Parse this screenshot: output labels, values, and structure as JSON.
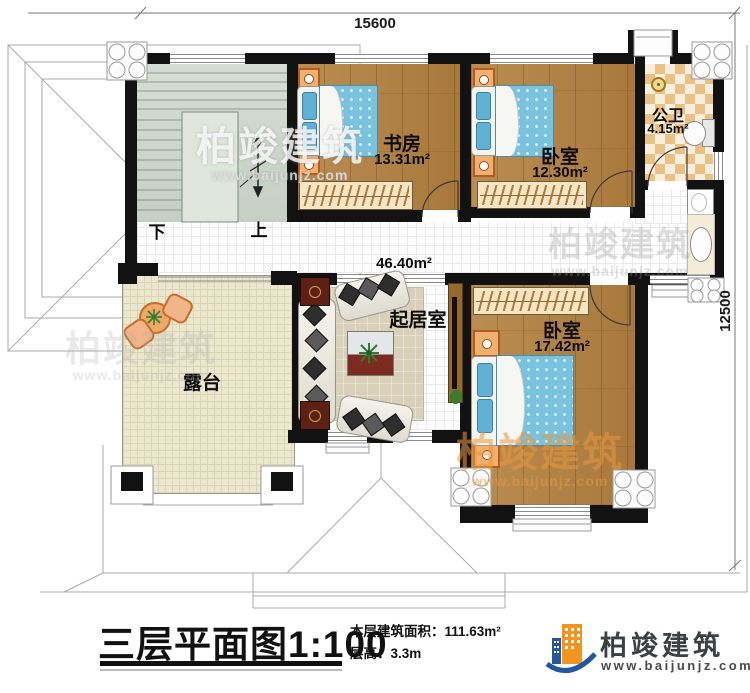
{
  "dimensions": {
    "width_mm": "15600",
    "height_mm": "12500"
  },
  "rooms": {
    "study": {
      "name": "书房",
      "area": "13.31m²"
    },
    "bedroom1": {
      "name": "卧室",
      "area": "12.30m²"
    },
    "bathroom": {
      "name": "公卫",
      "area": "4.15m²"
    },
    "living": {
      "name": "起居室",
      "area": "46.40m²"
    },
    "bedroom2": {
      "name": "卧室",
      "area": "17.42m²"
    },
    "terrace": {
      "name": "露台"
    }
  },
  "stairs": {
    "down": "下",
    "up": "上"
  },
  "title_block": {
    "title": "三层平面图",
    "scale": "1:100",
    "floor_area_label": "本层建筑面积：",
    "floor_area_value": "111.63m²",
    "floor_height_label": "层高：",
    "floor_height_value": "3.3m"
  },
  "brand": {
    "name": "柏竣建筑",
    "website": "www.baijunjz.com"
  },
  "watermark": {
    "text": "柏竣建筑",
    "url": "www.baijunjz.com"
  },
  "colors": {
    "wall": "#121212",
    "wood_floor": "#b2803e",
    "bed_blue": "#79c3df",
    "bath_checker": "#eac183",
    "terrace_floor": "#ece7cf",
    "stair_floor": "#cdd8cc",
    "brand_orange": "#f2951f",
    "brand_blue": "#2457a0",
    "watermark_orange": "#eb983c"
  }
}
